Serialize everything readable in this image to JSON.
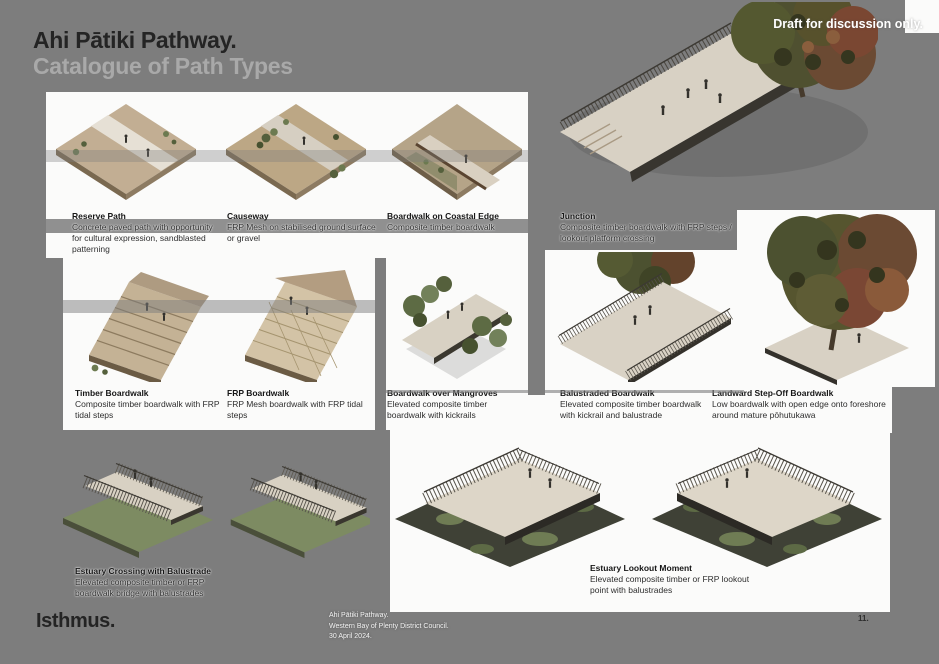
{
  "page": {
    "title_line1": "Ahi Pātiki Pathway.",
    "title_line2": "Catalogue of Path Types",
    "draft_note": "Draft for discussion only.",
    "logo": "Isthmus.",
    "footer": {
      "line1": "Ahi Pātiki Pathway.",
      "line2": "Western Bay of Plenty District Council.",
      "line3": "30 April 2024."
    },
    "page_number": "11."
  },
  "colors": {
    "background": "#7d7d7d",
    "panel": "#fbfbfa",
    "title_dark": "#242424",
    "title_muted": "#a9a9a9",
    "draft_white": "#ffffff"
  },
  "catalogue": {
    "items": [
      {
        "title": "Reserve Path",
        "description": "Concrete paved path with opportunity for cultural expression, sandblasted patterning"
      },
      {
        "title": "Causeway",
        "description": "FRP Mesh on stabilised ground surface or gravel"
      },
      {
        "title": "Boardwalk on Coastal Edge",
        "description": "Composite timber boardwalk"
      },
      {
        "title": "Junction",
        "description": "Composite timber boardwalk with FRP steps / lookout platform crossing"
      },
      {
        "title": "Timber Boardwalk",
        "description": "Composite timber boardwalk with FRP tidal steps"
      },
      {
        "title": "FRP Boardwalk",
        "description": "FRP Mesh boardwalk with FRP tidal steps"
      },
      {
        "title": "Boardwalk over Mangroves",
        "description": "Elevated composite timber boardwalk with kickrails"
      },
      {
        "title": "Balustraded Boardwalk",
        "description": "Elevated composite timber boardwalk with kickrail and balustrade"
      },
      {
        "title": "Landward Step-Off Boardwalk",
        "description": "Low boardwalk with open edge onto foreshore around mature pōhutukawa"
      },
      {
        "title": "Estuary Crossing with Balustrade",
        "description": "Elevated composite timber or FRP boardwalk bridge with balustrades"
      },
      {
        "title": "Estuary Lookout Moment",
        "description": "Elevated composite timber or FRP lookout point with balustrades"
      }
    ]
  }
}
